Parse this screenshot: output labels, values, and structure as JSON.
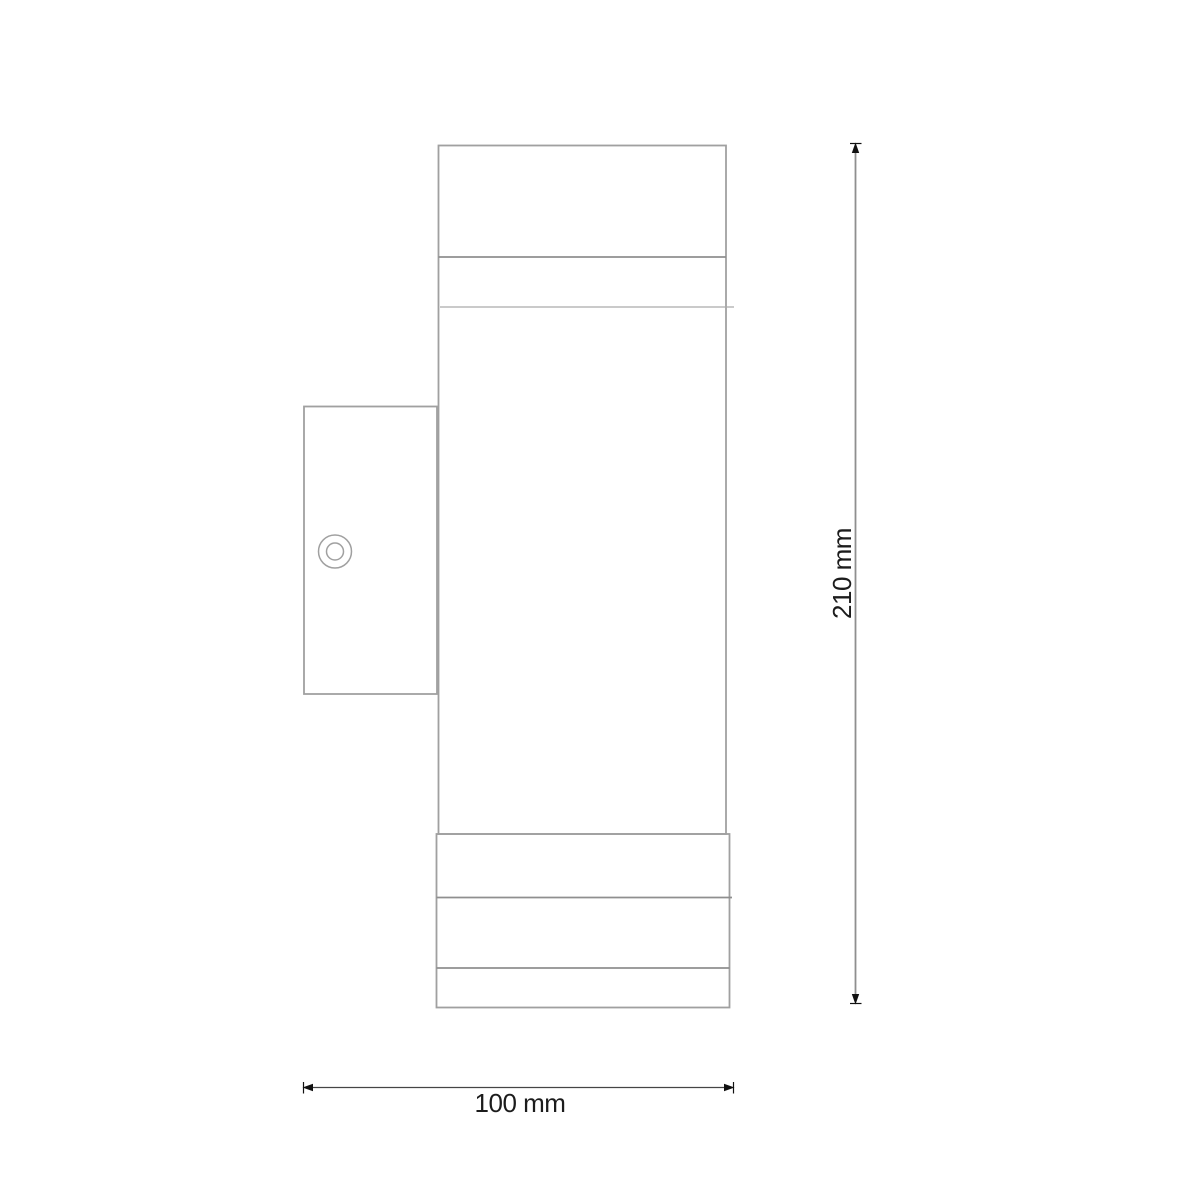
{
  "drawing": {
    "dimensions": {
      "height": {
        "label": "210 mm"
      },
      "width": {
        "label": "100 mm"
      }
    },
    "colors": {
      "background": "#ffffff",
      "outline": "#a0a0a0",
      "outline_dark": "#8f8f8f",
      "outline_light": "#ababab",
      "dimension_line_vertical": "#8f8f8f",
      "dimension_line_horizontal": "#454545",
      "arrow": "#111111",
      "text": "#1c1c1c"
    }
  }
}
